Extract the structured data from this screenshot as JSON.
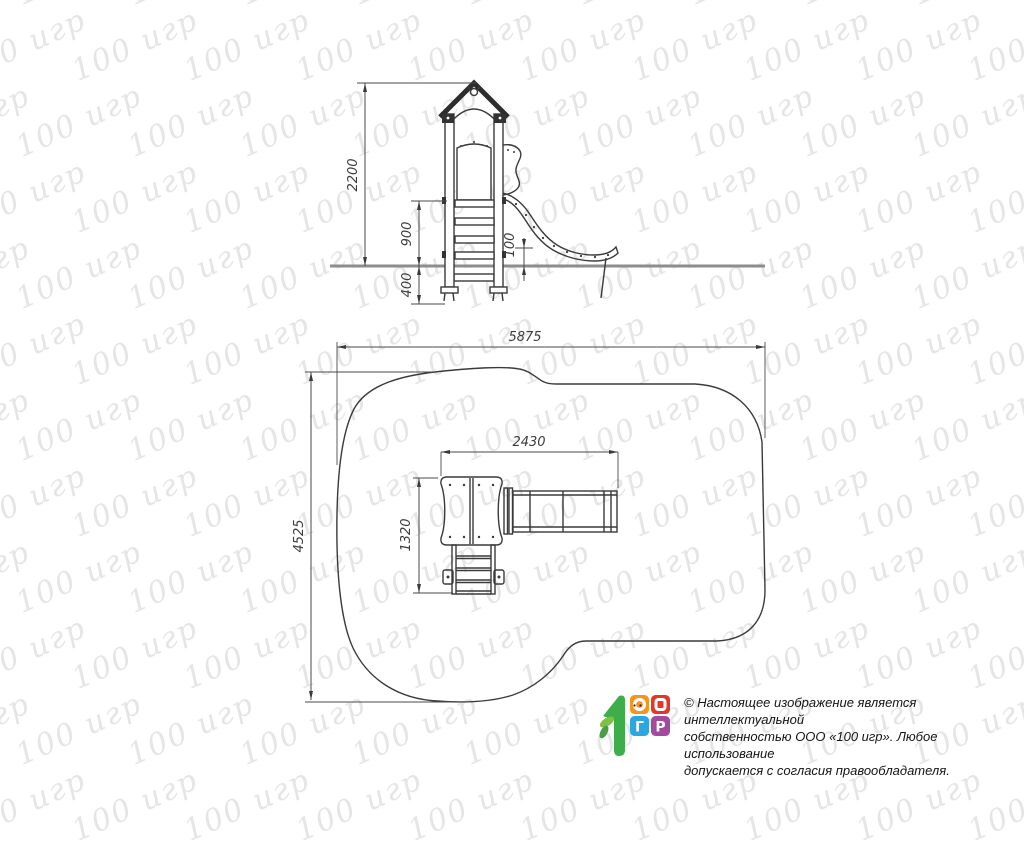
{
  "watermark": {
    "text": "100 игр"
  },
  "drawing": {
    "elevation": {
      "dim_total_height": "2200",
      "dim_platform_height": "900",
      "dim_foundation_depth": "400",
      "dim_slide_end_height": "100"
    },
    "plan": {
      "dim_zone_length": "5875",
      "dim_zone_width": "4525",
      "dim_equipment_length": "2430",
      "dim_equipment_width": "1320"
    }
  },
  "footer": {
    "logo": {
      "letter_g": "Г",
      "letter_r": "Р",
      "colors": {
        "green": "#3DAE49",
        "leaf_light": "#7DC242",
        "leaf_dark": "#4B9E47",
        "orange": "#F7941E",
        "red": "#E2382A",
        "blue": "#2BA6DF",
        "purple": "#A34A9E"
      }
    },
    "copyright_lines": [
      "© Настоящее изображение является интеллектуальной",
      "собственностью ООО «100 игр». Любое использование",
      "допускается с согласия правообладателя."
    ]
  }
}
